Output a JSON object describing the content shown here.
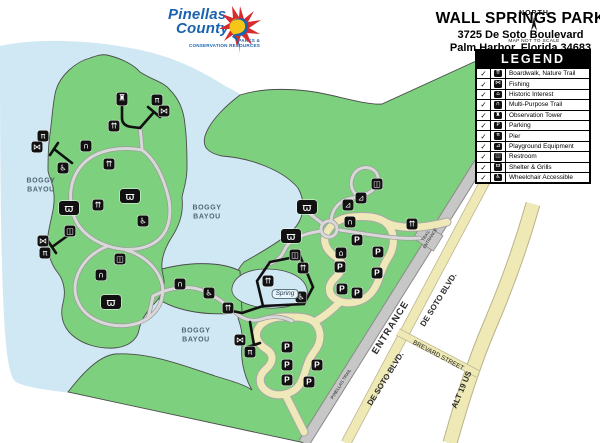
{
  "header": {
    "logo_line1": "Pinellas",
    "logo_line2": "County",
    "logo_sub1": "PARKS &",
    "logo_sub2": "CONSERVATION RESOURCES",
    "title": "WALL SPRINGS PARK",
    "address1": "3725 De Soto Boulevard",
    "address2": "Palm Harbor,  Florida 34683"
  },
  "north": {
    "label": "NORTH",
    "note": "MAP NOT TO SCALE"
  },
  "legend": {
    "title": "LEGEND",
    "check_glyph": "✓",
    "items": [
      {
        "icon": "boardwalk",
        "label": "Boardwalk, Nature Trail"
      },
      {
        "icon": "fishing",
        "label": "Fishing"
      },
      {
        "icon": "historic",
        "label": "Historic Interest"
      },
      {
        "icon": "multipurpose",
        "label": "Multi-Purpose Trail"
      },
      {
        "icon": "tower",
        "label": "Observation Tower"
      },
      {
        "icon": "parking",
        "label": "Parking"
      },
      {
        "icon": "pier",
        "label": "Pier"
      },
      {
        "icon": "playground",
        "label": "Playground Equipment"
      },
      {
        "icon": "restroom",
        "label": "Restroom"
      },
      {
        "icon": "shelter",
        "label": "Shelter & Grills"
      },
      {
        "icon": "wheelchair",
        "label": "Wheelchair Accessible"
      }
    ]
  },
  "icon_glyphs": {
    "boardwalk": "⇈",
    "fishing": "⋈",
    "historic": "⌂",
    "multipurpose": "∩",
    "tower": "♜",
    "parking": "P",
    "pier": "π",
    "playground": "⊿",
    "restroom": "◫",
    "shelter": "ϖ",
    "wheelchair": "♿"
  },
  "map": {
    "labels": [
      {
        "lines": [
          "BOGGY",
          "BAYOU"
        ],
        "x": 41,
        "y": 186,
        "cls": "water-label",
        "size": 7,
        "rot": 0
      },
      {
        "lines": [
          "BOGGY",
          "BAYOU"
        ],
        "x": 207,
        "y": 213,
        "cls": "water-label",
        "size": 7,
        "rot": 0
      },
      {
        "lines": [
          "BOGGY",
          "BAYOU"
        ],
        "x": 196,
        "y": 336,
        "cls": "water-label",
        "size": 7,
        "rot": 0
      },
      {
        "lines": [
          "ENTRANCE"
        ],
        "x": 391,
        "y": 328,
        "cls": "road-label",
        "size": 9.5,
        "rot": -58,
        "ls": 1
      },
      {
        "lines": [
          "PINELLAS TRAIL"
        ],
        "x": 341,
        "y": 384,
        "cls": "road-label-dark",
        "size": 4.4,
        "rot": -58
      },
      {
        "lines": [
          "TRAIL",
          "ENTRANCE"
        ],
        "x": 428,
        "y": 237,
        "cls": "road-label-dark",
        "size": 4.2,
        "rot": -58
      },
      {
        "lines": [
          "DE SOTO BLVD."
        ],
        "x": 439,
        "y": 300,
        "cls": "road-label",
        "size": 8,
        "rot": -58
      },
      {
        "lines": [
          "DE SOTO BLVD."
        ],
        "x": 386,
        "y": 379,
        "cls": "road-label",
        "size": 8,
        "rot": -58
      },
      {
        "lines": [
          "BREVARD STREET"
        ],
        "x": 438,
        "y": 356,
        "cls": "road-label-dark",
        "size": 6.3,
        "rot": 28
      },
      {
        "lines": [
          "ALT 19 US"
        ],
        "x": 462,
        "y": 390,
        "cls": "road-label",
        "size": 8,
        "rot": -67
      },
      {
        "lines": [
          "Spring"
        ],
        "x": 285,
        "y": 294,
        "cls": "spring-label",
        "size": 6.5,
        "rot": 0
      }
    ],
    "icons": [
      {
        "type": "tower",
        "x": 122,
        "y": 99
      },
      {
        "type": "pier",
        "x": 157,
        "y": 100
      },
      {
        "type": "fishing",
        "x": 164,
        "y": 111
      },
      {
        "type": "boardwalk",
        "x": 114,
        "y": 126
      },
      {
        "type": "pier",
        "x": 43,
        "y": 136
      },
      {
        "type": "fishing",
        "x": 37,
        "y": 147
      },
      {
        "type": "multipurpose",
        "x": 86,
        "y": 146
      },
      {
        "type": "wheelchair",
        "x": 63,
        "y": 168
      },
      {
        "type": "boardwalk",
        "x": 109,
        "y": 164
      },
      {
        "type": "shelter",
        "x": 130,
        "y": 196
      },
      {
        "type": "shelter",
        "x": 69,
        "y": 208
      },
      {
        "type": "boardwalk",
        "x": 98,
        "y": 205
      },
      {
        "type": "wheelchair",
        "x": 143,
        "y": 221
      },
      {
        "type": "restroom",
        "x": 70,
        "y": 231
      },
      {
        "type": "fishing",
        "x": 43,
        "y": 241
      },
      {
        "type": "pier",
        "x": 45,
        "y": 253
      },
      {
        "type": "restroom",
        "x": 120,
        "y": 259
      },
      {
        "type": "multipurpose",
        "x": 101,
        "y": 275
      },
      {
        "type": "shelter",
        "x": 111,
        "y": 302
      },
      {
        "type": "shelter",
        "x": 307,
        "y": 207
      },
      {
        "type": "shelter",
        "x": 291,
        "y": 236
      },
      {
        "type": "restroom",
        "x": 295,
        "y": 255
      },
      {
        "type": "boardwalk",
        "x": 303,
        "y": 268
      },
      {
        "type": "historic",
        "x": 341,
        "y": 253
      },
      {
        "type": "restroom",
        "x": 377,
        "y": 184
      },
      {
        "type": "playground",
        "x": 361,
        "y": 198
      },
      {
        "type": "playground",
        "x": 348,
        "y": 205
      },
      {
        "type": "multipurpose",
        "x": 350,
        "y": 222
      },
      {
        "type": "boardwalk",
        "x": 412,
        "y": 224
      },
      {
        "type": "boardwalk",
        "x": 268,
        "y": 281
      },
      {
        "type": "wheelchair",
        "x": 301,
        "y": 297
      },
      {
        "type": "multipurpose",
        "x": 180,
        "y": 284
      },
      {
        "type": "wheelchair",
        "x": 209,
        "y": 293
      },
      {
        "type": "boardwalk",
        "x": 228,
        "y": 308
      },
      {
        "type": "fishing",
        "x": 240,
        "y": 340
      },
      {
        "type": "pier",
        "x": 250,
        "y": 352
      },
      {
        "type": "parking",
        "x": 357,
        "y": 240
      },
      {
        "type": "parking",
        "x": 378,
        "y": 252
      },
      {
        "type": "parking",
        "x": 340,
        "y": 267
      },
      {
        "type": "parking",
        "x": 377,
        "y": 273
      },
      {
        "type": "parking",
        "x": 342,
        "y": 289
      },
      {
        "type": "parking",
        "x": 357,
        "y": 293
      },
      {
        "type": "parking",
        "x": 287,
        "y": 347
      },
      {
        "type": "parking",
        "x": 287,
        "y": 365
      },
      {
        "type": "parking",
        "x": 317,
        "y": 365
      },
      {
        "type": "parking",
        "x": 287,
        "y": 380
      },
      {
        "type": "parking",
        "x": 309,
        "y": 382
      }
    ]
  },
  "colors": {
    "water": "#cfe8f4",
    "land": "#7dd07d",
    "land_outline": "#4c4c4c",
    "road_tan": "#eee9b5",
    "road_tan_edge": "#b9b28b",
    "road_gray": "#c7c7c7",
    "road_gray_edge": "#8a8a8a",
    "trail": "#d8d8d8",
    "trail_edge": "#9a9a9a",
    "boardwalk": "#111111",
    "logo_blue": "#1a63ae",
    "logo_red": "#d92b2b",
    "logo_yellow": "#f5c518"
  }
}
